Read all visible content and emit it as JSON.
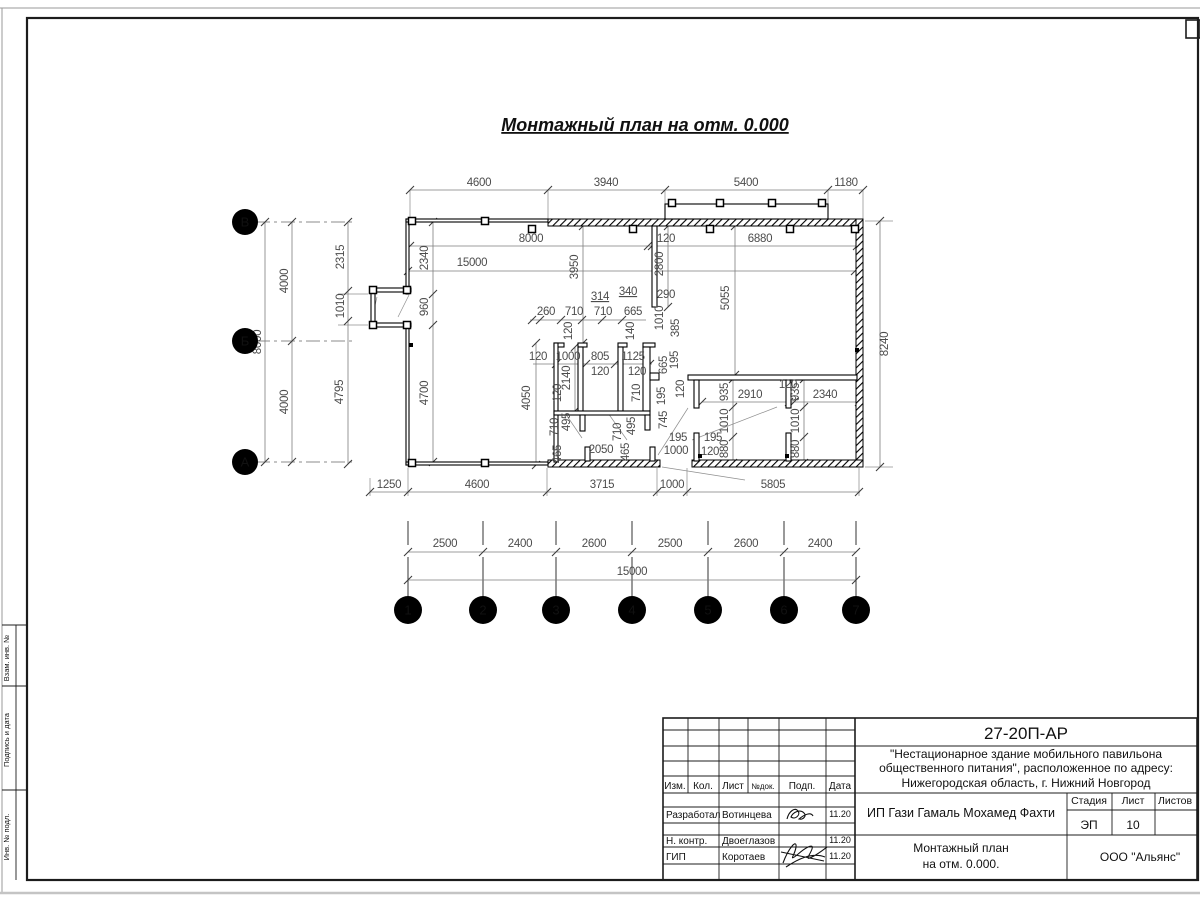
{
  "drawing": {
    "title": "Монтажный план на отм. 0.000",
    "axes": {
      "rows": [
        {
          "label": "В",
          "y": 222
        },
        {
          "label": "Б",
          "y": 341
        },
        {
          "label": "А",
          "y": 462
        }
      ],
      "cols": [
        {
          "label": "1",
          "x": 408
        },
        {
          "label": "2",
          "x": 483
        },
        {
          "label": "3",
          "x": 556
        },
        {
          "label": "4",
          "x": 632
        },
        {
          "label": "5",
          "x": 708
        },
        {
          "label": "6",
          "x": 784
        },
        {
          "label": "7",
          "x": 856
        }
      ]
    },
    "dim_labels": [
      {
        "t": "4600",
        "x": 479,
        "y": 186
      },
      {
        "t": "3940",
        "x": 606,
        "y": 186
      },
      {
        "t": "5400",
        "x": 746,
        "y": 186
      },
      {
        "t": "1180",
        "x": 846,
        "y": 186
      },
      {
        "t": "8000",
        "x": 531,
        "y": 242
      },
      {
        "t": "120",
        "x": 666,
        "y": 242
      },
      {
        "t": "6880",
        "x": 760,
        "y": 242
      },
      {
        "t": "15000",
        "x": 472,
        "y": 266
      },
      {
        "t": "2340",
        "x": 428,
        "y": 258,
        "r": 1
      },
      {
        "t": "960",
        "x": 428,
        "y": 307,
        "r": 1
      },
      {
        "t": "4700",
        "x": 428,
        "y": 393,
        "r": 1
      },
      {
        "t": "2315",
        "x": 344,
        "y": 257,
        "r": 1
      },
      {
        "t": "1010",
        "x": 344,
        "y": 306,
        "r": 1
      },
      {
        "t": "4795",
        "x": 343,
        "y": 392,
        "r": 1
      },
      {
        "t": "4000",
        "x": 288,
        "y": 281,
        "r": 1
      },
      {
        "t": "4000",
        "x": 288,
        "y": 402,
        "r": 1
      },
      {
        "t": "8000",
        "x": 261,
        "y": 342,
        "r": 1
      },
      {
        "t": "8240",
        "x": 888,
        "y": 344,
        "r": 1
      },
      {
        "t": "2800",
        "x": 663,
        "y": 264,
        "r": 1
      },
      {
        "t": "290",
        "x": 666,
        "y": 298
      },
      {
        "t": "5055",
        "x": 729,
        "y": 298,
        "r": 1
      },
      {
        "t": "3950",
        "x": 578,
        "y": 267,
        "r": 1
      },
      {
        "t": "314",
        "x": 600,
        "y": 300,
        "u": 1
      },
      {
        "t": "340",
        "x": 628,
        "y": 295,
        "u": 1
      },
      {
        "t": "260",
        "x": 546,
        "y": 315
      },
      {
        "t": "710",
        "x": 574,
        "y": 315
      },
      {
        "t": "710",
        "x": 603,
        "y": 315
      },
      {
        "t": "665",
        "x": 633,
        "y": 315
      },
      {
        "t": "140",
        "x": 634,
        "y": 331,
        "r": 1
      },
      {
        "t": "1010",
        "x": 663,
        "y": 318,
        "r": 1
      },
      {
        "t": "385",
        "x": 679,
        "y": 328,
        "r": 1
      },
      {
        "t": "120",
        "x": 572,
        "y": 331,
        "r": 1
      },
      {
        "t": "120",
        "x": 538,
        "y": 360
      },
      {
        "t": "1000",
        "x": 568,
        "y": 360
      },
      {
        "t": "805",
        "x": 600,
        "y": 360
      },
      {
        "t": "1125",
        "x": 633,
        "y": 360
      },
      {
        "t": "120",
        "x": 600,
        "y": 375
      },
      {
        "t": "120",
        "x": 637,
        "y": 375
      },
      {
        "t": "2140",
        "x": 570,
        "y": 378,
        "r": 1
      },
      {
        "t": "120",
        "x": 561,
        "y": 393,
        "r": 1
      },
      {
        "t": "4050",
        "x": 530,
        "y": 398,
        "r": 1
      },
      {
        "t": "665",
        "x": 667,
        "y": 365,
        "r": 1
      },
      {
        "t": "195",
        "x": 678,
        "y": 360,
        "r": 1
      },
      {
        "t": "710",
        "x": 640,
        "y": 393,
        "r": 1
      },
      {
        "t": "195",
        "x": 665,
        "y": 396,
        "r": 1
      },
      {
        "t": "745",
        "x": 667,
        "y": 420,
        "r": 1
      },
      {
        "t": "710",
        "x": 558,
        "y": 427,
        "r": 1
      },
      {
        "t": "495",
        "x": 570,
        "y": 422,
        "r": 1
      },
      {
        "t": "710",
        "x": 621,
        "y": 432,
        "r": 1
      },
      {
        "t": "495",
        "x": 635,
        "y": 426,
        "r": 1
      },
      {
        "t": "465",
        "x": 561,
        "y": 454,
        "r": 1
      },
      {
        "t": "465",
        "x": 629,
        "y": 452,
        "r": 1
      },
      {
        "t": "2050",
        "x": 601,
        "y": 453
      },
      {
        "t": "195",
        "x": 678,
        "y": 441
      },
      {
        "t": "1000",
        "x": 676,
        "y": 454
      },
      {
        "t": "195",
        "x": 713,
        "y": 441
      },
      {
        "t": "120",
        "x": 710,
        "y": 455
      },
      {
        "t": "120",
        "x": 684,
        "y": 389,
        "r": 1
      },
      {
        "t": "935",
        "x": 728,
        "y": 392,
        "r": 1
      },
      {
        "t": "1010",
        "x": 728,
        "y": 421,
        "r": 1
      },
      {
        "t": "880",
        "x": 728,
        "y": 449,
        "r": 1
      },
      {
        "t": "935",
        "x": 799,
        "y": 392,
        "r": 1
      },
      {
        "t": "1010",
        "x": 799,
        "y": 421,
        "r": 1
      },
      {
        "t": "880",
        "x": 799,
        "y": 449,
        "r": 1
      },
      {
        "t": "2910",
        "x": 750,
        "y": 398
      },
      {
        "t": "120",
        "x": 788,
        "y": 388
      },
      {
        "t": "2340",
        "x": 825,
        "y": 398
      },
      {
        "t": "1250",
        "x": 389,
        "y": 488
      },
      {
        "t": "4600",
        "x": 477,
        "y": 488
      },
      {
        "t": "3715",
        "x": 602,
        "y": 488
      },
      {
        "t": "1000",
        "x": 672,
        "y": 488
      },
      {
        "t": "5805",
        "x": 773,
        "y": 488
      },
      {
        "t": "2500",
        "x": 445,
        "y": 547
      },
      {
        "t": "2400",
        "x": 520,
        "y": 547
      },
      {
        "t": "2600",
        "x": 594,
        "y": 547
      },
      {
        "t": "2500",
        "x": 670,
        "y": 547
      },
      {
        "t": "2600",
        "x": 746,
        "y": 547
      },
      {
        "t": "2400",
        "x": 820,
        "y": 547
      },
      {
        "t": "15000",
        "x": 632,
        "y": 575
      }
    ],
    "dim_lines": [
      [
        410,
        190,
        863,
        190
      ],
      [
        410,
        246,
        857,
        246
      ],
      [
        408,
        271,
        855,
        271
      ],
      [
        433,
        222,
        433,
        462
      ],
      [
        348,
        222,
        348,
        464
      ],
      [
        292,
        222,
        292,
        462
      ],
      [
        265,
        222,
        265,
        462
      ],
      [
        880,
        221,
        880,
        467
      ],
      [
        668,
        226,
        668,
        307
      ],
      [
        735,
        226,
        735,
        375
      ],
      [
        583,
        226,
        583,
        343
      ],
      [
        530,
        320,
        646,
        320
      ],
      [
        533,
        364,
        652,
        364
      ],
      [
        536,
        343,
        536,
        465
      ],
      [
        575,
        347,
        575,
        411
      ],
      [
        702,
        402,
        859,
        402
      ],
      [
        733,
        379,
        733,
        463
      ],
      [
        804,
        379,
        804,
        463
      ],
      [
        370,
        492,
        860,
        492
      ],
      [
        408,
        552,
        856,
        552
      ],
      [
        408,
        580,
        856,
        580
      ]
    ],
    "ticks": {
      "h": [
        {
          "y": 190,
          "xs": [
            410,
            548,
            665,
            828,
            863
          ]
        },
        {
          "y": 246,
          "xs": [
            410,
            648,
            652,
            857
          ]
        },
        {
          "y": 271,
          "xs": [
            408,
            855
          ]
        },
        {
          "y": 320,
          "xs": [
            532,
            540,
            561,
            582,
            602,
            622
          ]
        },
        {
          "y": 364,
          "xs": [
            556,
            586,
            615,
            650
          ]
        },
        {
          "y": 402,
          "xs": [
            702,
            789,
            794,
            859
          ]
        },
        {
          "y": 492,
          "xs": [
            370,
            408,
            547,
            657,
            687,
            859
          ]
        },
        {
          "y": 552,
          "xs": [
            408,
            483,
            556,
            632,
            708,
            784,
            856
          ]
        },
        {
          "y": 580,
          "xs": [
            408,
            856
          ]
        }
      ],
      "v": [
        {
          "x": 433,
          "ys": [
            222,
            294,
            325,
            462
          ]
        },
        {
          "x": 348,
          "ys": [
            222,
            291,
            321,
            464
          ]
        },
        {
          "x": 292,
          "ys": [
            222,
            341,
            462
          ]
        },
        {
          "x": 265,
          "ys": [
            222,
            462
          ]
        },
        {
          "x": 880,
          "ys": [
            221,
            467
          ]
        },
        {
          "x": 668,
          "ys": [
            226,
            307
          ]
        },
        {
          "x": 735,
          "ys": [
            226,
            375
          ]
        },
        {
          "x": 583,
          "ys": [
            226,
            343
          ]
        },
        {
          "x": 536,
          "ys": [
            343,
            465
          ]
        },
        {
          "x": 575,
          "ys": [
            347,
            411
          ]
        },
        {
          "x": 733,
          "ys": [
            379,
            407,
            437,
            463
          ]
        },
        {
          "x": 804,
          "ys": [
            379,
            407,
            437,
            463
          ]
        }
      ]
    },
    "ext_lines": [
      [
        410,
        190,
        410,
        219
      ],
      [
        548,
        190,
        548,
        219
      ],
      [
        665,
        190,
        665,
        204
      ],
      [
        828,
        190,
        828,
        204
      ],
      [
        863,
        190,
        863,
        219
      ],
      [
        368,
        294,
        338,
        294
      ],
      [
        368,
        325,
        338,
        325
      ],
      [
        865,
        221,
        893,
        221
      ],
      [
        865,
        467,
        893,
        467
      ],
      [
        370,
        478,
        370,
        496
      ],
      [
        408,
        468,
        408,
        496
      ],
      [
        547,
        468,
        547,
        496
      ],
      [
        657,
        468,
        657,
        496
      ],
      [
        687,
        468,
        687,
        496
      ],
      [
        859,
        468,
        859,
        496
      ]
    ],
    "walls_thick": [
      [
        548,
        219,
        315,
        7
      ],
      [
        856,
        219,
        7,
        248
      ],
      [
        548,
        460,
        112,
        7
      ],
      [
        692,
        460,
        171,
        7
      ]
    ],
    "walls_thin": [
      [
        406,
        219,
        3,
        75
      ],
      [
        406,
        324,
        3,
        141
      ],
      [
        406,
        219,
        142,
        3
      ],
      [
        406,
        462,
        142,
        3
      ],
      [
        371,
        288,
        40,
        4
      ],
      [
        371,
        323,
        40,
        4
      ],
      [
        371,
        288,
        4,
        39
      ],
      [
        665,
        204,
        163,
        15
      ],
      [
        652,
        226,
        5,
        81
      ],
      [
        554,
        343,
        10,
        4
      ],
      [
        578,
        343,
        9,
        4
      ],
      [
        618,
        343,
        9,
        4
      ],
      [
        643,
        343,
        12,
        4
      ],
      [
        554,
        343,
        4,
        119
      ],
      [
        578,
        347,
        5,
        64
      ],
      [
        618,
        347,
        5,
        64
      ],
      [
        643,
        347,
        7,
        64
      ],
      [
        554,
        411,
        96,
        4
      ],
      [
        580,
        415,
        5,
        16
      ],
      [
        645,
        415,
        5,
        15
      ],
      [
        585,
        447,
        5,
        14
      ],
      [
        650,
        447,
        5,
        14
      ],
      [
        650,
        373,
        9,
        7
      ],
      [
        688,
        375,
        169,
        5
      ],
      [
        694,
        380,
        5,
        28
      ],
      [
        786,
        380,
        5,
        28
      ],
      [
        694,
        433,
        5,
        28
      ],
      [
        786,
        433,
        5,
        28
      ]
    ],
    "squares": [
      [
        412,
        221
      ],
      [
        485,
        221
      ],
      [
        412,
        463
      ],
      [
        485,
        463
      ],
      [
        532,
        229
      ],
      [
        633,
        229
      ],
      [
        710,
        229
      ],
      [
        790,
        229
      ],
      [
        855,
        229
      ],
      [
        672,
        203
      ],
      [
        720,
        203
      ],
      [
        772,
        203
      ],
      [
        822,
        203
      ],
      [
        373,
        290
      ],
      [
        407,
        290
      ],
      [
        373,
        325
      ],
      [
        407,
        325
      ]
    ],
    "dots": [
      [
        411,
        345
      ],
      [
        857,
        350
      ],
      [
        700,
        456
      ],
      [
        787,
        456
      ]
    ],
    "leaders": [
      [
        662,
        467,
        745,
        480
      ],
      [
        688,
        408,
        658,
        455
      ],
      [
        692,
        440,
        777,
        407
      ],
      [
        372,
        318,
        377,
        297
      ],
      [
        398,
        317,
        409,
        295
      ],
      [
        565,
        413,
        582,
        438
      ],
      [
        608,
        413,
        627,
        440
      ]
    ]
  },
  "titleblock": {
    "code": "27-20П-АР",
    "project_line1": "\"Нестационарное здание мобильного павильона",
    "project_line2": "общественного питания\", расположенное по адресу:",
    "project_line3": "Нижегородская область, г. Нижний Новгород",
    "headers": {
      "izm": "Изм.",
      "kol": "Кол.",
      "list": "Лист",
      "ndok": "№док.",
      "podp": "Подп.",
      "data": "Дата"
    },
    "rows": [
      {
        "role": "Разработал",
        "name": "Вотинцева",
        "date": "11.20"
      },
      {
        "role": "Н. контр.",
        "name": "Двоеглазов",
        "date": "11.20"
      },
      {
        "role": "ГИП",
        "name": "Коротаев",
        "date": "11.20"
      }
    ],
    "client": "ИП Гази Гамаль Мохамед Фахти",
    "stage_label": "Стадия",
    "sheet_label": "Лист",
    "sheets_label": "Листов",
    "stage": "ЭП",
    "sheet": "10",
    "sheets": "",
    "doc_title1": "Монтажный план",
    "doc_title2": "на отм. 0.000.",
    "company": "ООО \"Альянс\""
  },
  "frame": {
    "side_labels": [
      "Взам. инв. №",
      "Подпись и дата",
      "Инв. № подл."
    ]
  }
}
